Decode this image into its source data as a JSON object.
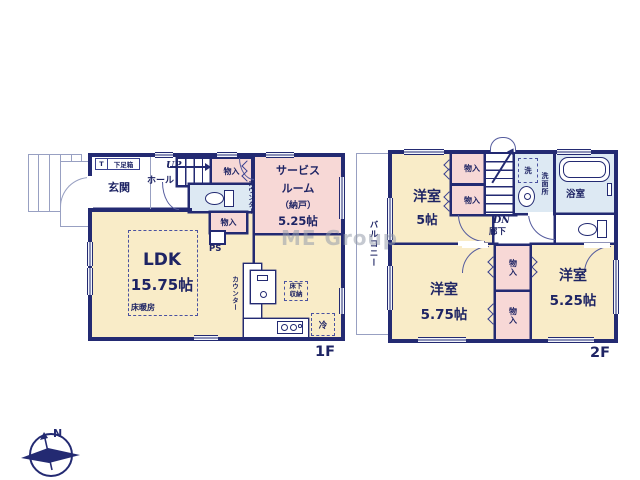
{
  "watermark": "ME Group",
  "compass": {
    "north": "N"
  },
  "floor1": {
    "label": "1F",
    "entrance": "玄関",
    "entrance_t": "T",
    "shoe_box": "下足箱",
    "hall": "ホール",
    "stairs_up": "UP",
    "closet_top": "物入",
    "closet_mid": "物入",
    "counter_side": "カウンター",
    "service_room": {
      "line1": "サービス",
      "line2": "ルーム",
      "line3": "（納戸）",
      "size": "5.25帖"
    },
    "pipe_space": "PS",
    "ldk": {
      "name": "LDK",
      "size": "15.75帖",
      "floor_heating": "床暖房"
    },
    "kitchen": {
      "counter": "カウンター",
      "underfloor_storage": "床下収納",
      "fridge": "冷"
    }
  },
  "floor2": {
    "label": "2F",
    "balcony": "バルコニー",
    "bedroom_a": {
      "name": "洋室",
      "size": "5帖"
    },
    "bedroom_b": {
      "name": "洋室",
      "size": "5.75帖"
    },
    "bedroom_c": {
      "name": "洋室",
      "size": "5.25帖"
    },
    "closet_a": "物入",
    "closet_b": "物入",
    "closet_c": "物入",
    "closet_d": "物入",
    "stairs_down": "DN",
    "corridor": "廊下",
    "laundry": "洗",
    "washroom": "洗面所",
    "bathroom": "浴室"
  },
  "colors": {
    "wall": "#232a72",
    "room": "#f9ecc8",
    "storage": "#f7d8d6",
    "wet_area": "#dde9f3"
  }
}
